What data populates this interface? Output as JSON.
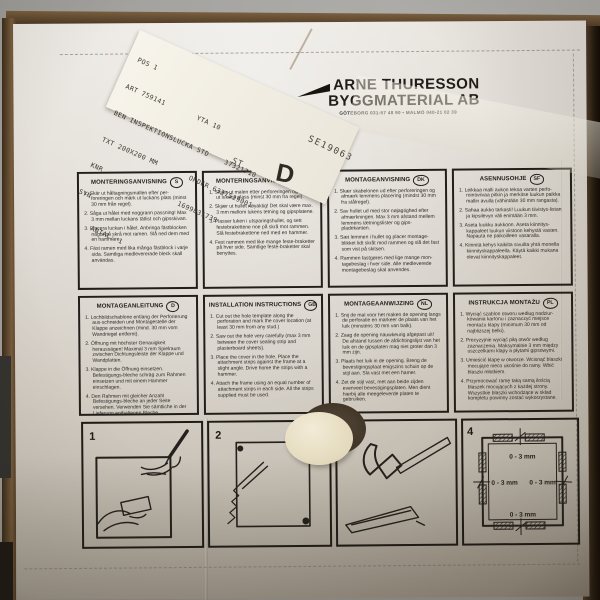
{
  "scene": {
    "background_color": "#a8a7a3",
    "cardboard_color": "#5d4730",
    "sheet_color": "#ddd8d0",
    "ink_color": "#2d2a25"
  },
  "header": {
    "company_line1": "ARNE THURESSON",
    "company_line2": "BYGGMATERIAL AB",
    "contact_line": "GÖTEBORG 031-57 48 90  •  MALMÖ 040-21 02 39"
  },
  "sticker": {
    "lines": [
      "POS 1",
      "ART 759141        YTA 10",
      "BEN INSPEKTIONSLUCKA STD    37321710",
      "TXT 200X200 MM        ORDER 6337529001",
      "KNR                   1699831739",
      "SYN",
      "      ANTAL: 1"
    ]
  },
  "stamps": {
    "st": "ST",
    "d": "D",
    "serial": "SE19063"
  },
  "panels": [
    {
      "title": "MONTERINGSANVISNING",
      "code": "S",
      "steps": [
        "1. Skär ut håltagningsmallen efter per-foreringen och märk ut luckans plats (minst 30 mm från regel).",
        "2. Såga ut hålet med noggrann passning! Max 3 mm mellan luckans tätlist och gipsskivan.",
        "3. Placera luckan i hålet. Anbringa fästblocken något på skrå mot ramen. Slå ned dem med en hammare.",
        "4. Fäst ramen med lika många fästblock i varje sida. Samtliga medlevererade bleck skall användas."
      ]
    },
    {
      "title": "MONTERINGSANVISNING",
      "code": "N",
      "steps": [
        "1. Skjær ut malen etter perforeringen og merk ut lukens plass (minst 30 mm fra regel).",
        "2. Skjær ut hullet nøyaktig! Det skal være max. 3 mm mellom lukens tetning og gipsplatene.",
        "3. Plasser luken i utsparingshullet, og sett festebrakettene noe på skrå mot rammen. Slå festebrakettene ned med en hammer.",
        "4. Fest rammen med like mange feste-braketter på hver side. Samtlige feste-braketter skal benyttes."
      ]
    },
    {
      "title": "MONTAGEANVISNING",
      "code": "DK",
      "steps": [
        "1. Skær skabelonen ud efter perforeringen og afmærk lemmens placering (mindst 30 mm fra stålregel).",
        "2. Sav hullet ud med stor nøjagtighed efter afmærkningen. Max 3 mm afstand mellem lemmens tætningslister og gips-pladekanten.",
        "3. Sæt lemmen i hullet og placer montage-blikket lidt skråt mod rammen og slå det fast som vist på skitsen.",
        "4. Rammen fastgøres med lige mange mon-tagebeslag i hver side. Alle medleverede montagebeslag skal anvendes."
      ]
    },
    {
      "title": "ASENNUSOHJE",
      "code": "SF",
      "steps": [
        "1. Leikkaa malli aukon tekoa varten perfo-rointiviivaa pitkin ja merkitse luukun paikka mallin avulla (vähintään 30 mm rangasta).",
        "2. Sahaa aukko tarkasti! Luukun tiivistys-listan ja kipsilevyn väli enintään 3 mm.",
        "3. Aseta luukku aukkoon. Aseta kiinnitys-kappaleet luukun viistoon kehystä vasten. Napauta ne paikoilleen vasaralla.",
        "4. Kiinnitä kehys kaikilta sivuilta yhtä monella kiinnityskappaleella. Käytä kaikki mukana olevat kiinnityskappaleet."
      ]
    },
    {
      "title": "MONTAGEANLEITUNG",
      "code": "D",
      "steps": [
        "1. Lochbildschablone entlang der Perforierung aus-schneiden und Montagestelle der Klappe anzeichnen (mind. 30 mm vom Wandriegel entfernt).",
        "2. Öffnung mit höchster Genauigkeit heraussägen! Maximal 3 mm Spielraum zwischen Dichtungsleiste der Klappe und Wandplatten.",
        "3. Klappe in die Öffnung einsetzen. Befestigungs-bleche schräg zum Rahmen einsetzen und mit einem Hammer einschlagen.",
        "4. Den Rahmen mit gleicher Anzahl Befestigungs-bleche an jeder Seite versehen. Verwenden Sie sämtliche in der Lieferung enthaltenen Bleche."
      ]
    },
    {
      "title": "INSTALLATION INSTRUCTIONS",
      "code": "GB",
      "steps": [
        "1. Cut out the hole template along the perforation and mark the cover location (at least 30 mm from any stud.)",
        "2. Saw out the hole very carefully (max 3 mm between the cover sealing strip and plasterboard sheets).",
        "3. Place the cover in the hole. Place the attachment strips against the frame at a slight angle. Drive home the strips with a hammer.",
        "4. Attach the frame using an equal number of attachment strips in each side. All the strips supplied must be used."
      ]
    },
    {
      "title": "MONTAGEAANWIJZING",
      "code": "NL",
      "steps": [
        "1. Snij de mal voor het maken de opening langs de perforatie en markeer de plaats van het luik (minstens 30 mm van balk).",
        "2. Zaag de opening nauwkeurig afgepast uit! De afstand tussen de afdichtingslijst van het luik en de gipsplaten mag niet groter dan 3 mm zijn.",
        "3. Plaats het luik in de opening. Breng de bevestigingsplaat enigszins schuin op de stijl aan. Sla vast met een hamer.",
        "4. Zet de stijl vast, met aan beide zijden evenveel bevestigingsplaten. Men dient hierbij alle meegeleverde platen te gebruiken."
      ]
    },
    {
      "title": "INSTRUKCJA MONTAŻU",
      "code": "PL",
      "steps": [
        "1. Wyciąć szablon otworu według nadziur-kowania kartonu i zaznaczyć miejsce montażu klapy (minimum 30 mm od najbliższej belki).",
        "2. Precyzyjnie wyciąć piłą otwór według zaznaczenia. Maksymalnie 3 mm między uszczelkami klapy a płytami gipsowymi.",
        "3. Umieścić klapę w otworze. Wcisnąć blaszki mocujące nieco ukośnie do ramy. Wbić blaszki młotkiem.",
        "4. Przymocować ramę taką samą ilością blaszek mocujących z każdej strony. Wszystkie blaszki wchodzące w skład kompletu powinny zostać wykorzystane."
      ]
    }
  ],
  "figures": [
    {
      "number": "1"
    },
    {
      "number": "2"
    },
    {
      "number": "3"
    },
    {
      "number": "4",
      "labels": [
        "0 - 3 mm",
        "0 - 3 mm",
        "0 - 3 mm",
        "0 - 3 mm"
      ]
    }
  ]
}
